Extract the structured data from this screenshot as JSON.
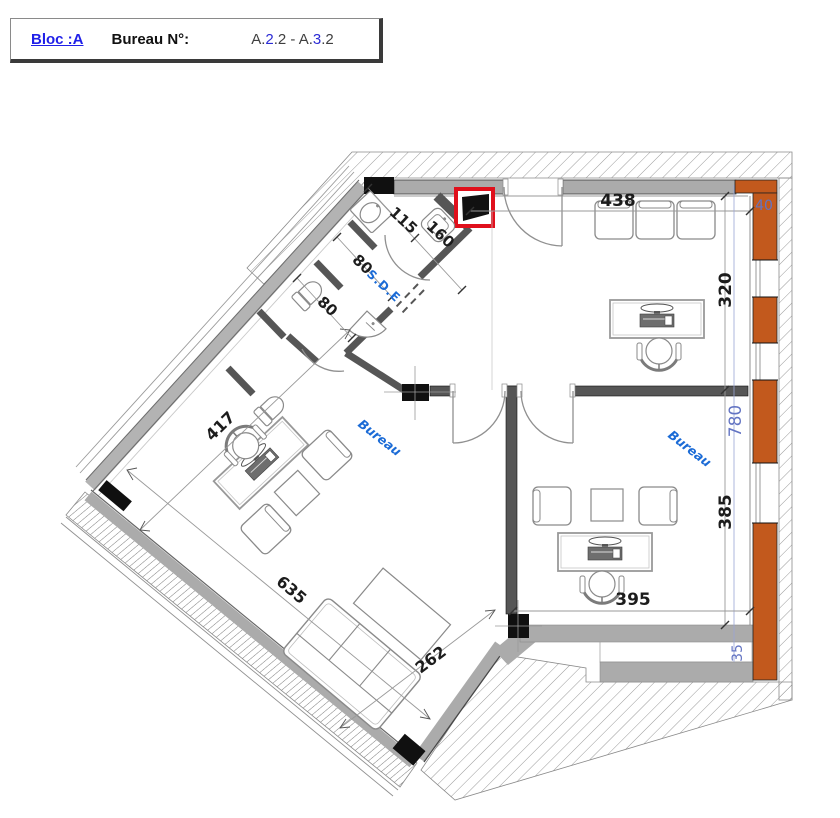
{
  "title_block": {
    "bloc_label": "Bloc :A",
    "bureau_label": "Bureau N°:",
    "room_number_segments": [
      {
        "text": "A.",
        "color": "#3f3f3f"
      },
      {
        "text": "2",
        "color": "#2b2bd4"
      },
      {
        "text": ".2 - A.",
        "color": "#3f3f3f"
      },
      {
        "text": "3",
        "color": "#2b2bd4"
      },
      {
        "text": ".2",
        "color": "#3f3f3f"
      }
    ]
  },
  "plan": {
    "room_labels": {
      "bureau_left": "Bureau",
      "bureau_right": "Bureau",
      "sde": "S.D.E"
    },
    "dimensions": {
      "d438": "438",
      "d320": "320",
      "d385": "385",
      "d395": "395",
      "d635": "635",
      "d262": "262",
      "d417": "417",
      "d115": "115",
      "d160": "160",
      "d80a": "80",
      "d80b": "80",
      "d780": "780",
      "d40": "40",
      "d35": "35"
    },
    "colors": {
      "wall_orange": "#C2591D",
      "dim_blue": "#6374C3",
      "label_blue": "#1B6BD6",
      "shaft_red": "#E0101C",
      "wall_gray": "#ACACAC",
      "partition_gray": "#565656"
    }
  }
}
